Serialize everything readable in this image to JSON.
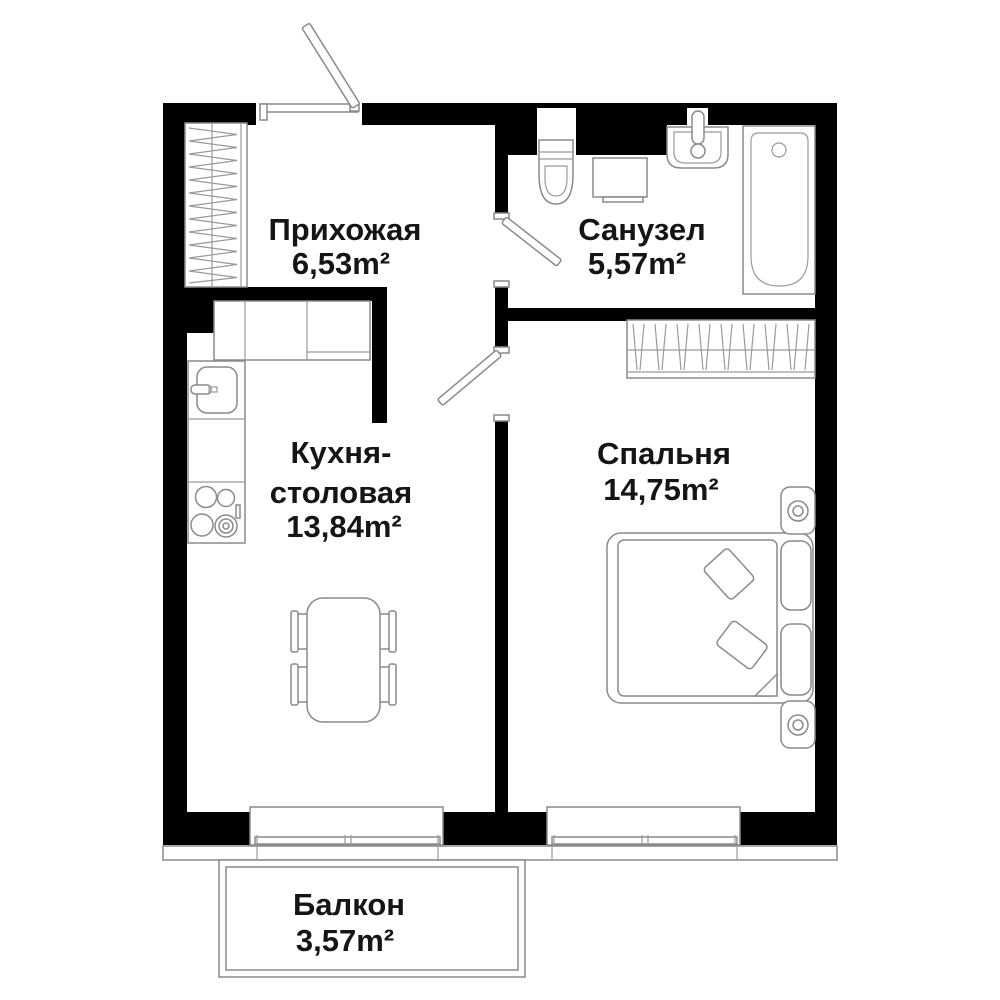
{
  "plan": {
    "rooms": {
      "hallway": {
        "name": "Прихожая",
        "area": "6,53m²"
      },
      "bathroom": {
        "name": "Санузел",
        "area": "5,57m²"
      },
      "kitchen": {
        "name_line_1": "Кухня-",
        "name_line_2": "столовая",
        "area": "13,84m²"
      },
      "bedroom": {
        "name": "Спальня",
        "area": "14,75m²"
      },
      "balcony": {
        "name": "Балкон",
        "area": "3,57m²"
      }
    },
    "colors": {
      "wall": "#000000",
      "furniture_line": "#8a8a8a",
      "text": "#151515",
      "background": "#ffffff"
    }
  }
}
